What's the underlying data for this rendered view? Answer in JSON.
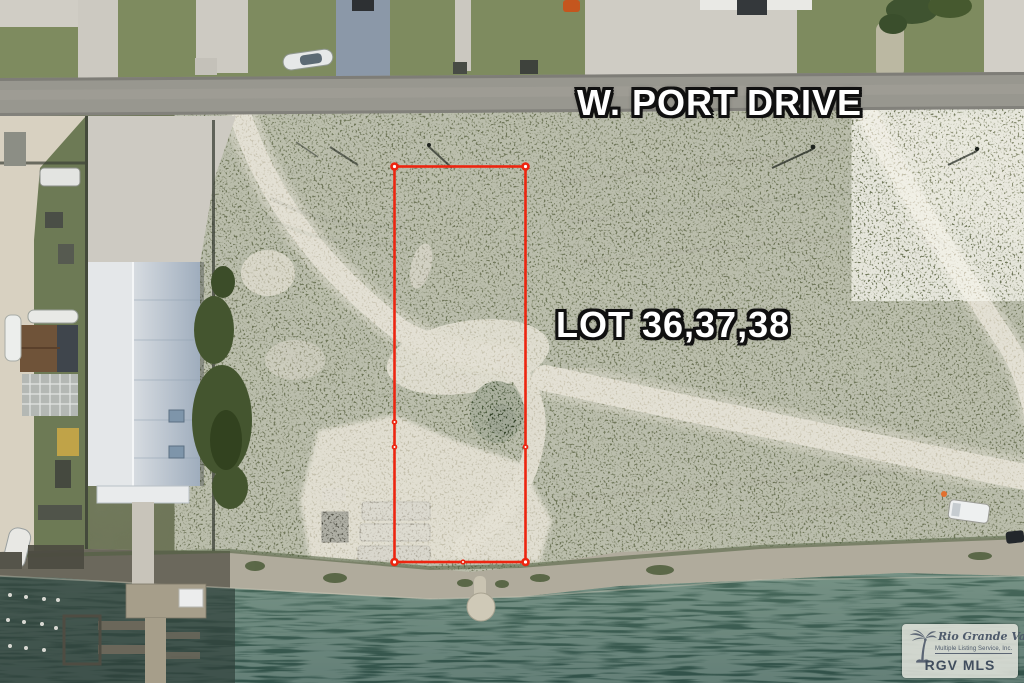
{
  "annotations": {
    "road_label": "W. PORT DRIVE",
    "lot_label": "LOT 36,37,38"
  },
  "watermark": {
    "icon": "palm-tree-icon",
    "org_name": "Rio Grande Valley",
    "org_subtitle": "Multiple Listing Service, Inc.",
    "abbr": "RGV MLS"
  },
  "colors": {
    "boundary_red": "#ed2510",
    "water_teal": "#3f6254",
    "field_green": "#6f7659",
    "road_gray": "#98978f",
    "watermark_text": "#4e5a6b"
  }
}
